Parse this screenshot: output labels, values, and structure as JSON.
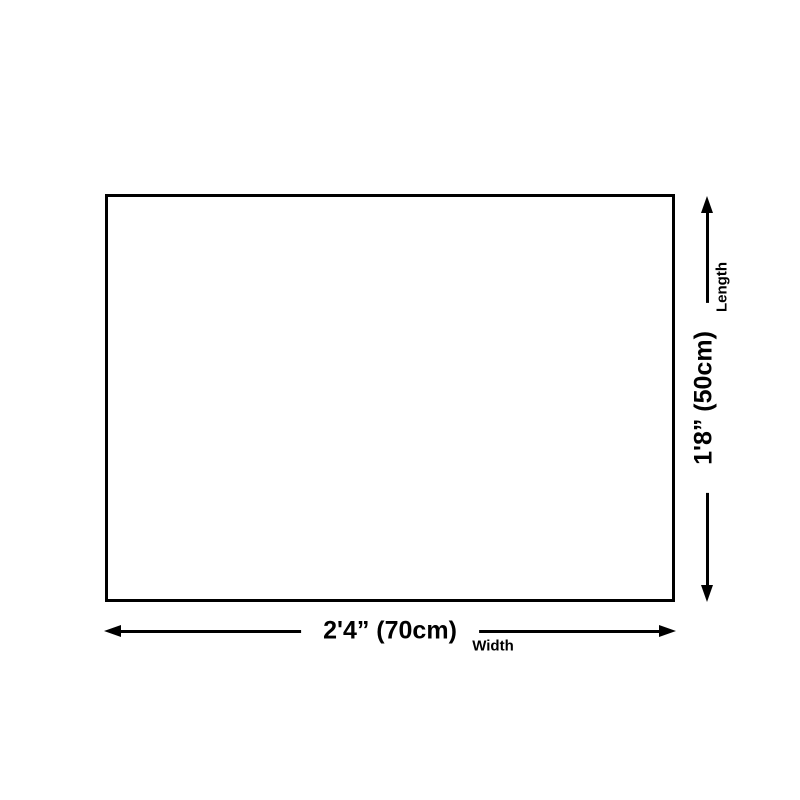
{
  "colors": {
    "ink": "#000000",
    "background": "#ffffff"
  },
  "diagram": {
    "width_dimension": {
      "value": "2'4” (70cm)",
      "label": "Width"
    },
    "length_dimension": {
      "value": "1'8” (50cm)",
      "label": "Length"
    }
  }
}
